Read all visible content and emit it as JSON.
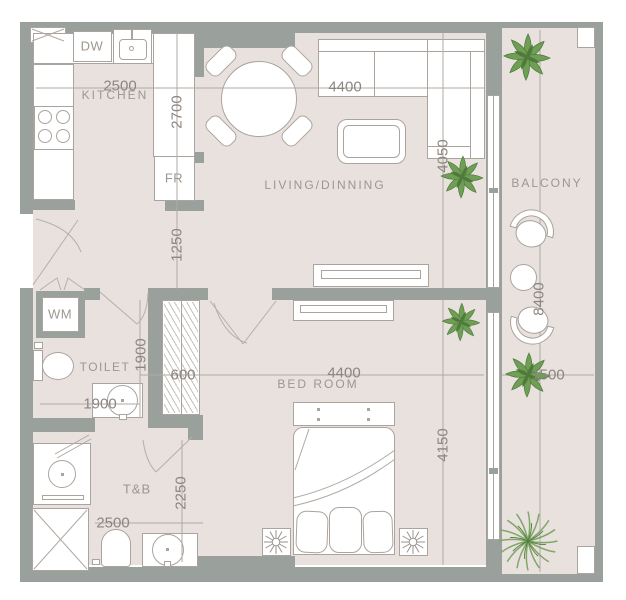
{
  "colors": {
    "wall": "#9aa09c",
    "floor": "#e8e1dd",
    "line": "#aba49e",
    "dimline": "#b1aaa4",
    "room-text": "#9d978f",
    "dim-text": "#8b8680",
    "plant": "#6f9e55",
    "plant-dark": "#4f7a3c",
    "palm": "#7fa768"
  },
  "rooms": {
    "kitchen": "KITCHEN",
    "living": "LIVING/DINNING",
    "balcony": "BALCONY",
    "toilet": "TOILET",
    "bedroom": "BED ROOM",
    "tnb": "T&B"
  },
  "appliances": {
    "dishwasher": "DW",
    "fridge": "FR",
    "washer": "WM"
  },
  "dims": {
    "kitchen_width": "2500",
    "kitchen_depth": "2700",
    "hallway_width": "1250",
    "living_width": "4400",
    "living_depth": "4050",
    "toilet_depth": "1900",
    "toilet_width": "1900",
    "wardrobe_depth": "600",
    "bedroom_width": "4400",
    "bedroom_depth": "4150",
    "tnb_depth": "2250",
    "tnb_width": "2500",
    "balcony_length": "8400",
    "balcony_width": "1500"
  }
}
